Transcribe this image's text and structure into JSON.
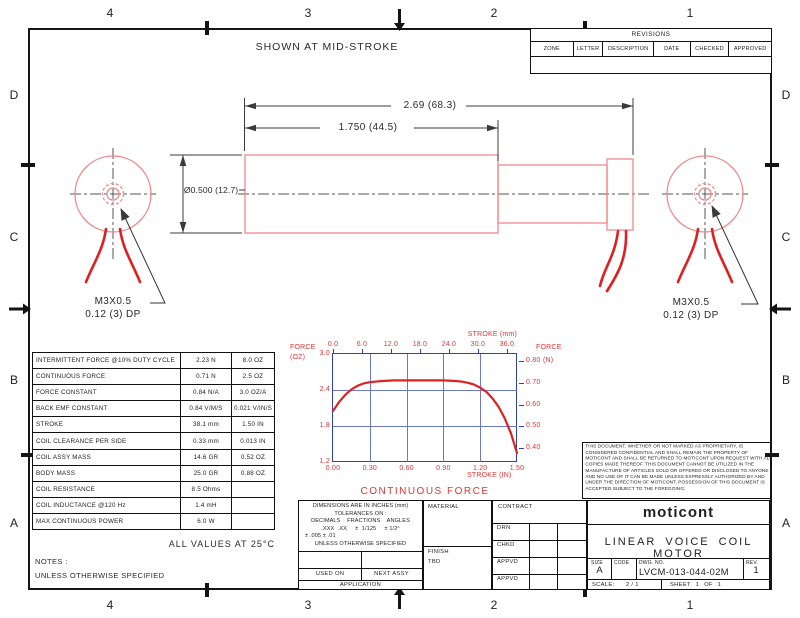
{
  "colors": {
    "outline_red": "#f0898b",
    "wire_red": "#dd1f1f",
    "chart_red": "#e23434",
    "grid_blue": "#6b78cb",
    "frame_blue": "#3040ae",
    "ink": "#1f1f1f",
    "dim_gray": "#3c3c3c"
  },
  "zones": {
    "columns": [
      "4",
      "3",
      "2",
      "1"
    ],
    "rows": [
      "D",
      "C",
      "B",
      "A"
    ]
  },
  "revisions": {
    "title": "REVISIONS",
    "columns": [
      "ZONE",
      "LETTER",
      "DESCRIPTION",
      "DATE",
      "CHECKED",
      "APPROVED"
    ]
  },
  "drawing": {
    "note_top": "SHOWN AT MID-STROKE",
    "dims": {
      "total": "2.69 (68.3)",
      "body": "1.750 (44.5)",
      "diameter": "Ø0.500 (12.7)"
    },
    "thread_callout": [
      "M3X0.5",
      "0.12 (3) DP"
    ]
  },
  "specs": {
    "rows": [
      [
        "INTERMITTENT FORCE @10% DUTY CYCLE",
        "2.23 N",
        "8.0 OZ"
      ],
      [
        "CONTINUOUS FORCE",
        "0.71 N",
        "2.5 OZ"
      ],
      [
        "FORCE CONSTANT",
        "0.84 N/A",
        "3.0 OZ/A"
      ],
      [
        "BACK EMF CONSTANT",
        "0.84 V/M/S",
        "0.021 V/IN/S"
      ],
      [
        "STROKE",
        "38.1 mm",
        "1.50 IN"
      ],
      [
        "COIL CLEARANCE PER SIDE",
        "0.33 mm",
        "0.013 IN"
      ],
      [
        "COIL ASSY MASS",
        "14.6 GR",
        "0.52 OZ"
      ],
      [
        "BODY MASS",
        "25.0 GR",
        "0.88 OZ"
      ],
      [
        "COIL RESISTANCE",
        "8.5 Ohms",
        ""
      ],
      [
        "COIL INDUCTANCE @120 Hz",
        "1.4 mH",
        ""
      ],
      [
        "MAX CONTINUOUS POWER",
        "6.0 W",
        ""
      ]
    ],
    "footnote": "ALL VALUES AT 25°C",
    "notes": [
      "NOTES :",
      "UNLESS OTHERWISE SPECIFIED"
    ]
  },
  "chart_data": {
    "type": "line",
    "title": "CONTINUOUS FORCE",
    "top_axis": {
      "label": "STROKE (mm)",
      "ticks": [
        "0.0",
        "6.0",
        "12.0",
        "18.0",
        "24.0",
        "30.0",
        "36.0"
      ],
      "range": [
        0,
        38.1
      ]
    },
    "bottom_axis": {
      "label": "STROKE (IN)",
      "ticks": [
        "0.00",
        "0.30",
        "0.60",
        "0.90",
        "1.20",
        "1.50"
      ],
      "range": [
        0,
        1.5
      ]
    },
    "left_axis": {
      "label": "FORCE",
      "unit": "(OZ)",
      "ticks": [
        "3.0",
        "2.4",
        "1.8",
        "1.2"
      ],
      "range": [
        1.2,
        3.0
      ]
    },
    "right_axis": {
      "label": "FORCE",
      "unit": "(N)",
      "ticks": [
        "0.80",
        "0.70",
        "0.60",
        "0.50",
        "0.40"
      ],
      "range": [
        0.3336,
        0.834
      ]
    },
    "grid": true,
    "series": [
      {
        "name": "CONTINUOUS FORCE",
        "color": "#dd2222",
        "x": [
          0,
          0.05,
          0.1,
          0.15,
          0.2,
          0.25,
          0.3,
          0.4,
          0.5,
          0.6,
          0.7,
          0.8,
          0.9,
          1.0,
          1.05,
          1.1,
          1.15,
          1.2,
          1.25,
          1.3,
          1.35,
          1.4,
          1.45,
          1.5
        ],
        "y": [
          2.05,
          2.2,
          2.32,
          2.41,
          2.47,
          2.51,
          2.53,
          2.55,
          2.56,
          2.56,
          2.56,
          2.56,
          2.56,
          2.55,
          2.54,
          2.52,
          2.49,
          2.44,
          2.37,
          2.26,
          2.12,
          1.93,
          1.68,
          1.35
        ]
      }
    ]
  },
  "legal": {
    "text": "THIS DOCUMENT, WHETHER OR NOT MARKED AS PROPRIETARY, IS CONSIDERED CONFIDENTIAL AND SHALL REMAIN THE PROPERTY OF MOTICONT AND SHALL BE RETURNED TO MOTICONT UPON REQUEST WITH ALL COPIES MADE THEREOF. THIS DOCUMENT CANNOT BE UTILIZED IN THE MANUFACTURE OF ARTICLES SOLD OR OFFERED OR DISCLOSED TO ANYONE AND NO USE OF IT CAN BE MADE UNLESS EXPRESSLY AUTHORIZED BY AND UNDER THE DIRECTION OF MOTICONT. POSSESSION OF THIS DOCUMENT IS ACCEPTED SUBJECT TO THE FOREGOING."
  },
  "tolerance_block": {
    "lines": [
      "DIMENSIONS ARE IN INCHES (mm)",
      "TOLERANCES ON :",
      "DECIMALS    FRACTIONS    ANGLES",
      ".XXX  .XX     ±  1/125     ± 1/2°",
      "± .005 ± .01",
      "UNLESS OTHERWISE SPECIFIED"
    ],
    "used_on": "USED ON",
    "next_assy": "NEXT ASSY",
    "application": "APPLICATION"
  },
  "material_block": {
    "material_label": "MATERIAL",
    "finish_label": "FINISH",
    "finish_value": "TBD"
  },
  "contract_block": {
    "contract_label": "CONTRACT",
    "rows": [
      "DRN",
      "CHKD",
      "APPVD",
      "APPVD"
    ]
  },
  "title_block": {
    "company": "moticont",
    "title": "LINEAR VOICE COIL MOTOR",
    "size_label": "SIZE",
    "size": "A",
    "code_label": "CODE",
    "dwg_label": "DWG. NO.",
    "dwg_no": "LVCM-013-044-02M",
    "rev_label": "REV.",
    "rev": "1",
    "scale_label": "SCALE:",
    "scale": "2 / 1",
    "sheet": "SHEET 1 OF 1"
  }
}
